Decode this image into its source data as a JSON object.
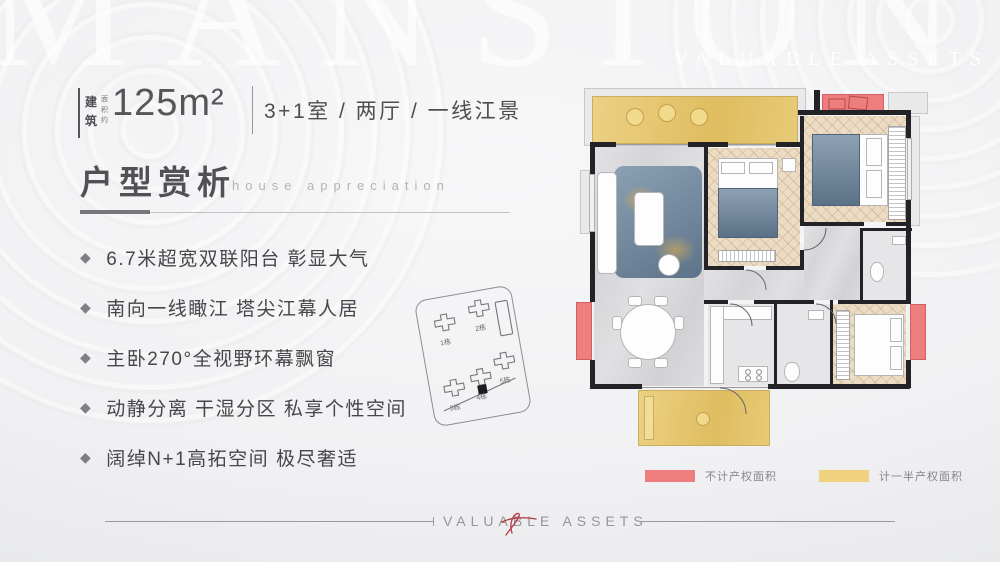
{
  "watermark": {
    "top": "MANSION",
    "top_right": "VALUABLE ASSETS"
  },
  "header": {
    "area_label_main": "建筑",
    "area_label_sub": "面积约",
    "area_value": "125m²",
    "unit_desc": "3+1室 / 两厅 / 一线江景"
  },
  "section": {
    "title": "户型赏析",
    "subtitle": "house appreciation"
  },
  "features": [
    "6.7米超宽双联阳台 彰显大气",
    "南向一线瞰江 塔尖江幕人居",
    "主卧270°全视野环幕飘窗",
    "动静分离 干湿分区 私享个性空间",
    "阔绰N+1高拓空间 极尽奢适"
  ],
  "sitemap": {
    "buildings": [
      "1栋",
      "2栋",
      "3栋",
      "4栋",
      "5栋"
    ]
  },
  "legend": [
    {
      "label": "不计产权面积",
      "color": "#ee7e7e"
    },
    {
      "label": "计一半产权面积",
      "color": "#f0d27e"
    }
  ],
  "footer": {
    "text": "VALUABLE ASSETS"
  },
  "colors": {
    "balcony_yellow": "#e7cb74",
    "no_property_red": "#ee7e7e",
    "wood_floor": "#ecdcc4",
    "wall_black": "#232327"
  }
}
